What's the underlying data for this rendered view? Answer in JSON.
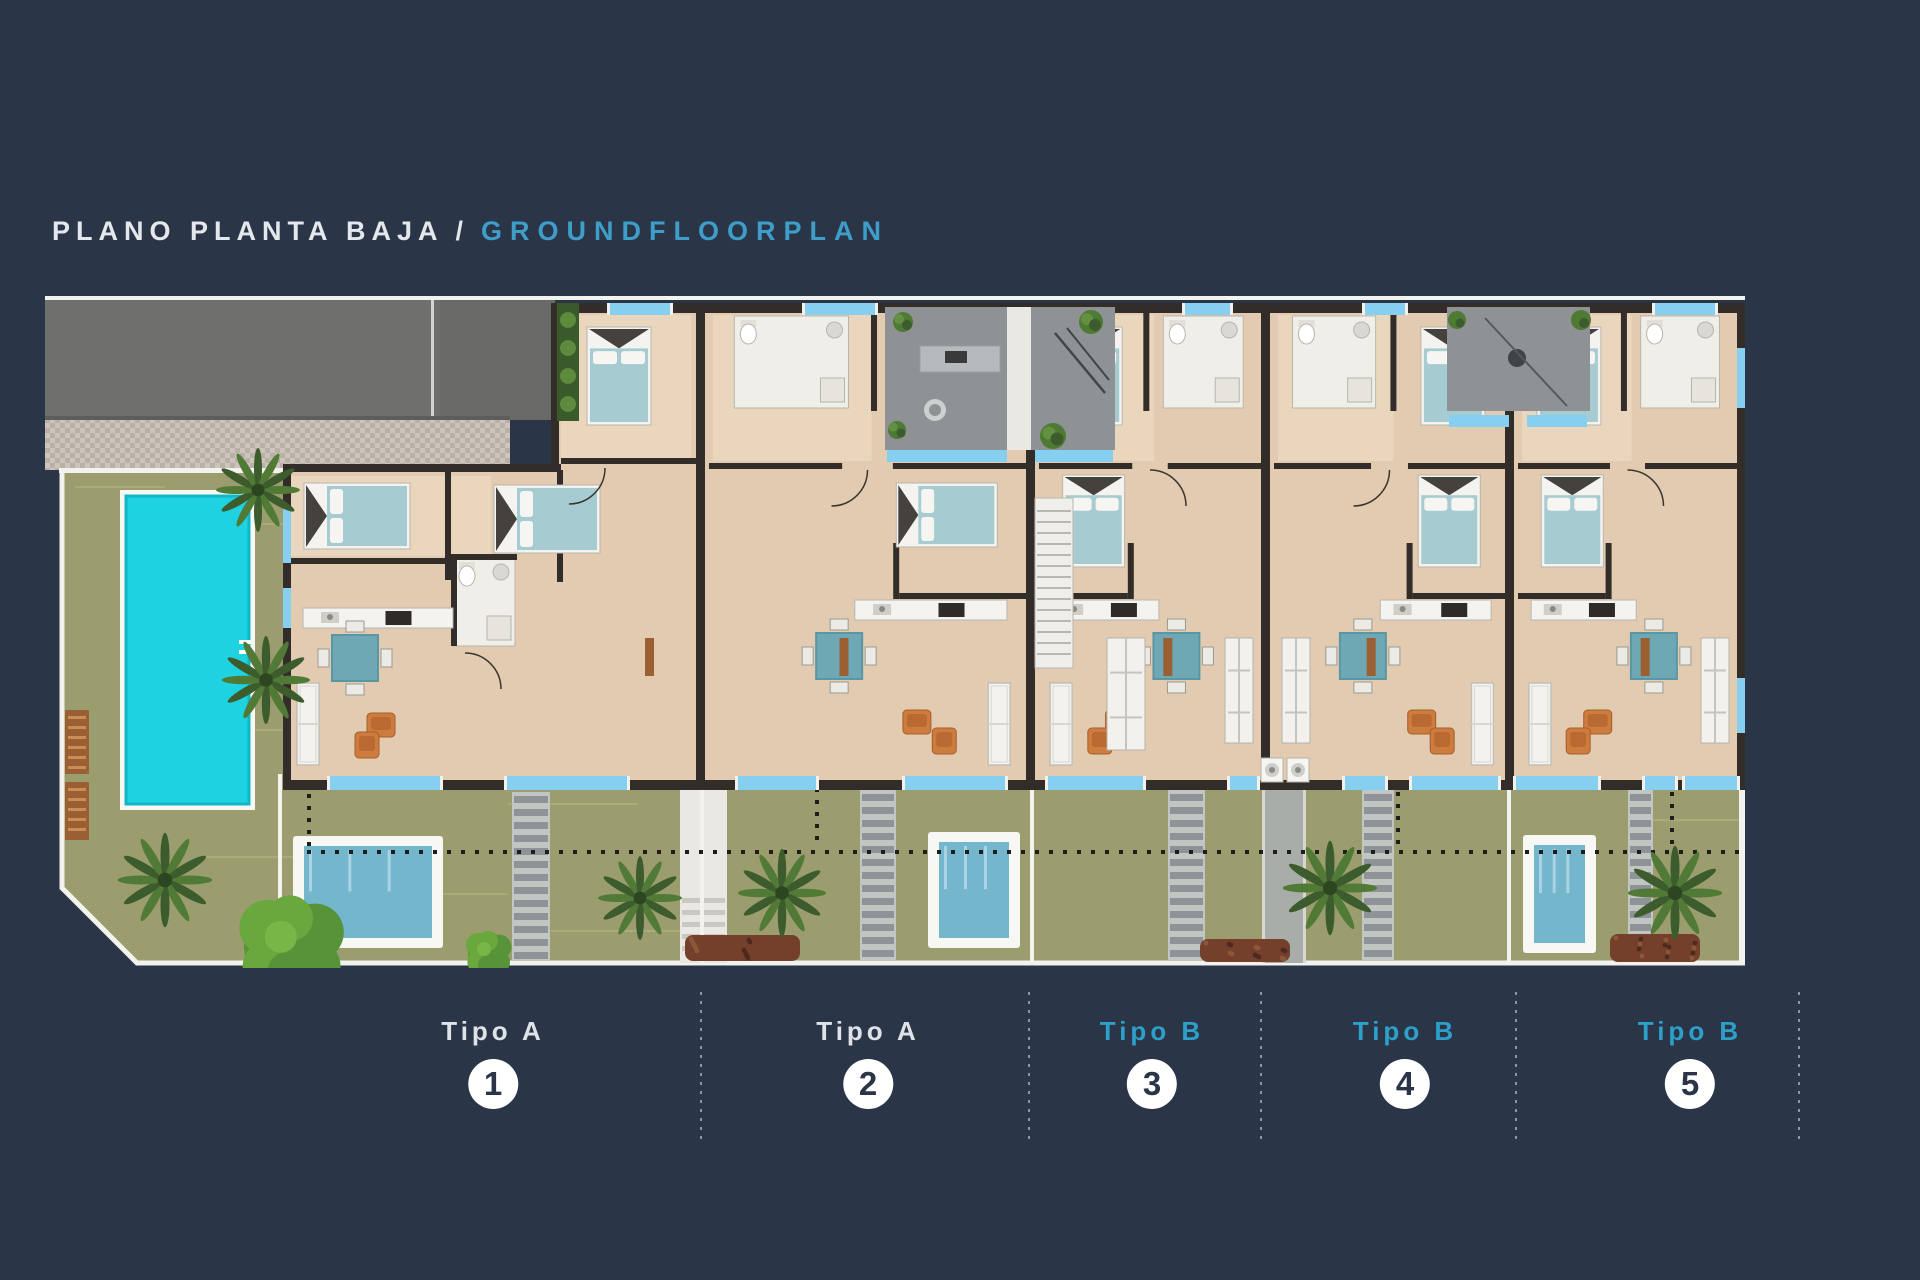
{
  "page": {
    "background_color": "#2a3547"
  },
  "title": {
    "primary": "PLANO PLANTA BAJA",
    "separator": "/",
    "secondary": "GROUNDFLOORPLAN",
    "primary_color": "#e4e8ed",
    "secondary_color": "#3f9dc9"
  },
  "units": [
    {
      "label": "Tipo A",
      "number": "1",
      "label_color": "#dfe3e8"
    },
    {
      "label": "Tipo A",
      "number": "2",
      "label_color": "#dfe3e8"
    },
    {
      "label": "Tipo B",
      "number": "3",
      "label_color": "#2d9fc9"
    },
    {
      "label": "Tipo B",
      "number": "4",
      "label_color": "#2d9fc9"
    },
    {
      "label": "Tipo B",
      "number": "5",
      "label_color": "#2d9fc9"
    }
  ],
  "badge": {
    "background": "#ffffff",
    "number_color": "#2a3547"
  },
  "plan": {
    "colors": {
      "wall": "#322d28",
      "floor": "#e2cbb0",
      "floor_light": "#e9d6bd",
      "window_blue": "#87cff0",
      "courtyard_gray": "#8e9294",
      "driveway_gray": "#6f706e",
      "paving_gray": "#c6beb5",
      "garden_green": "#9b9d6e",
      "communal_pool_cyan": "#1fd2e0",
      "plunge_pool_teal": "#74b7cd",
      "deck_white": "#f7f7f4",
      "bed_teal": "#a6ccd1",
      "table_teal": "#6fa8b5",
      "sofa_white": "#f3f2ee",
      "armchair_orange": "#cd7c3e",
      "wood_brown": "#9a5f33",
      "palm_green": "#3c5c2d",
      "bush_green": "#68a83d",
      "mulch_brown": "#74402c",
      "stair_gray": "#8d9396",
      "property_line_black": "#1d1d1b",
      "boundary_white": "#f2f2ee"
    }
  }
}
